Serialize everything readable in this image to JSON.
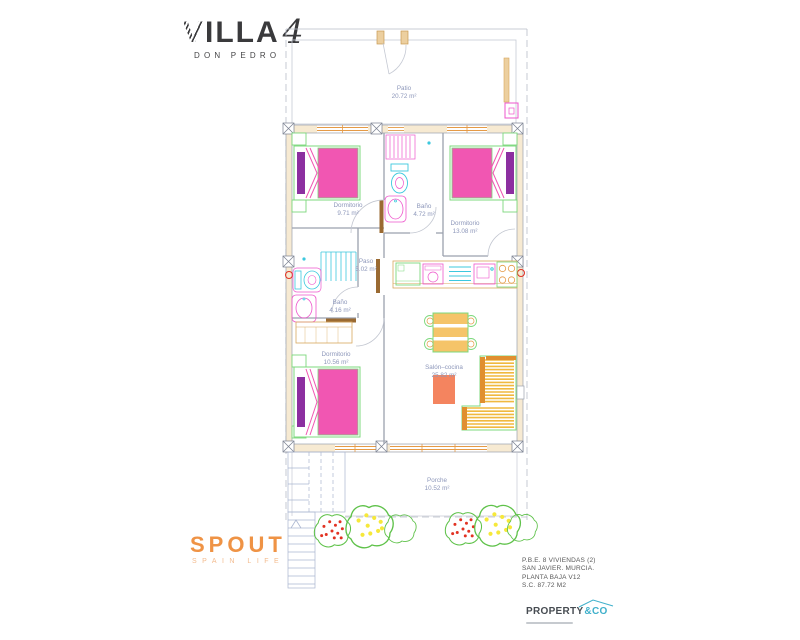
{
  "branding": {
    "villa": {
      "name": "VILLA",
      "number": "4",
      "subtitle": "DON PEDRO"
    },
    "spout": {
      "name": "SPOUT",
      "subtitle": "SPAIN LIFE"
    },
    "property": {
      "name": "PROPERTY",
      "suffix": "&CO"
    }
  },
  "project_info": {
    "lines": [
      "P.B.E. 8 VIVIENDAS (2)",
      "SAN JAVIER. MURCIA.",
      "PLANTA BAJA V12",
      "S.C. 87.72 M2"
    ]
  },
  "rooms": [
    {
      "id": "patio",
      "name": "Patio",
      "area": "20.72 m²"
    },
    {
      "id": "dormitorio1",
      "name": "Dormitorio",
      "area": "9.71 m²"
    },
    {
      "id": "bano1",
      "name": "Baño",
      "area": "4.72 m²"
    },
    {
      "id": "dormitorio2",
      "name": "Dormitorio",
      "area": "13.08 m²"
    },
    {
      "id": "paso",
      "name": "Paso",
      "area": "5.02 m²"
    },
    {
      "id": "bano2",
      "name": "Baño",
      "area": "4.16 m²"
    },
    {
      "id": "dormitorio3",
      "name": "Dormitorio",
      "area": "10.56 m²"
    },
    {
      "id": "salon",
      "name": "Salón–cocina",
      "area": "25.82 m²"
    },
    {
      "id": "porche",
      "name": "Porche",
      "area": "10.52 m²"
    }
  ],
  "colors": {
    "spout_orange": "#ef9345",
    "property_teal": "#3fb0cb",
    "label_blue": "#8d97ba",
    "bed_pink": "#f156b2",
    "pillow_purple": "#8c2fa0",
    "furniture_green": "#7cd87c",
    "fixture_magenta": "#ee55cc",
    "fixture_cyan": "#3cc8de",
    "wall_tan": "#f7ead2",
    "window_orange": "#e59a46",
    "sofa_yellow": "#f0b93f",
    "rug_salmon": "#f4845f",
    "plant_green": "#5fc24a",
    "marker_red": "#e23222"
  }
}
